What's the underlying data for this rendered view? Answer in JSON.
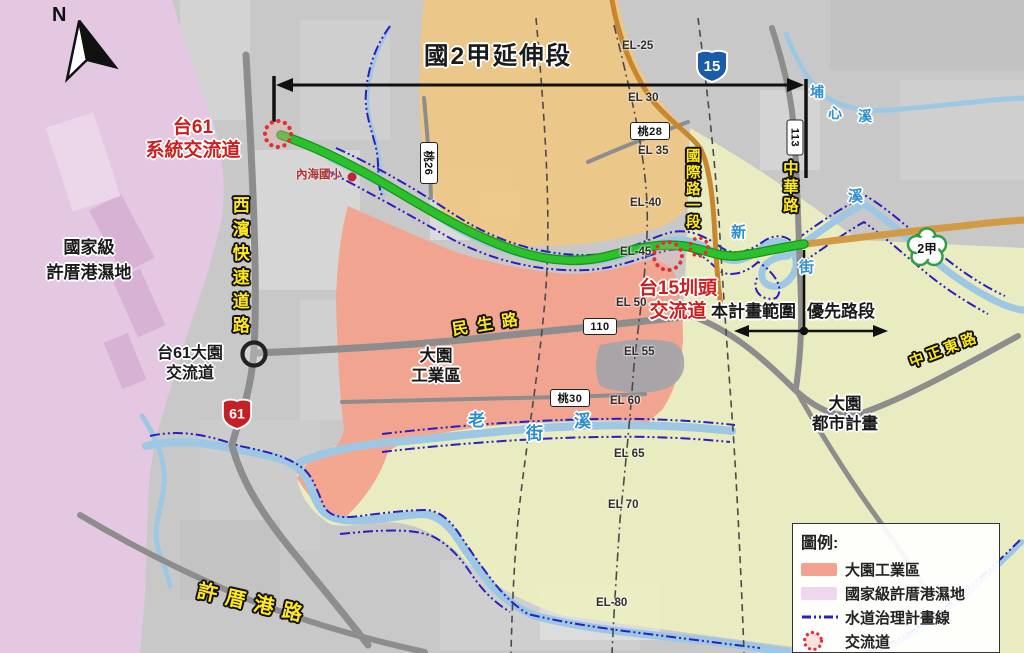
{
  "colors": {
    "route-green": "#2cc02c",
    "route-green-dark": "#179417",
    "road-brown": "#c8872e",
    "road-tan": "#d29a45",
    "river": "#9ec7e4",
    "waterline": "#2a1fbf",
    "wetland": "#e4c8e2",
    "industrial": "#f2a28e",
    "urban": "#ebedc0",
    "farm-orange": "#eec787",
    "label-red": "#cc2020",
    "label-blue": "#2e8fd0",
    "road-label-yellow": "#ffe81e",
    "shield-blue": "#1a5ca8",
    "shield-red": "#c42127",
    "shield-green": "#2f9e44"
  },
  "compass": {
    "label": "N"
  },
  "title": {
    "text": "國2甲延伸段"
  },
  "scope": {
    "project_range": "本計畫範圍",
    "priority_section": "優先路段"
  },
  "interchanges": {
    "tai61_system": "台61\n系統交流道",
    "tai61_dayuan": "台61大園\n交流道",
    "tai15_zhuntou": "台15圳頭\n交流道"
  },
  "areas": {
    "wetland": "國家級\n許厝港濕地",
    "industrial": "大園\n工業區",
    "urban_plan": "大園\n都市計畫"
  },
  "poi": {
    "neihai_school": "內海國小"
  },
  "roads": {
    "xibin": "西濱快速道路",
    "minsheng": "民生路",
    "guoji": "國際路一段",
    "zhonghua": "中華路",
    "zhongzheng_e": "中正東路",
    "xucuogang": "許厝港路"
  },
  "rivers": {
    "laojie": [
      "老",
      "街",
      "溪"
    ],
    "puxin": [
      "埔",
      "心",
      "溪"
    ],
    "xinjie": [
      "新",
      "街",
      "溪"
    ]
  },
  "markers": {
    "tao26": "桃26",
    "tao28": "桃28",
    "tao30": "桃30",
    "r110": "110",
    "r113": "113",
    "r15": "15",
    "r61": "61",
    "r2a": "2甲"
  },
  "el_labels": [
    "EL-25",
    "EL 30",
    "EL 35",
    "EL-40",
    "EL-45",
    "EL 50",
    "EL 55",
    "EL 60",
    "EL 65",
    "EL 70",
    "EL-80"
  ],
  "legend": {
    "title": "圖例:",
    "items": [
      {
        "label": "大園工業區"
      },
      {
        "label": "國家級許厝港濕地"
      },
      {
        "label": "水道治理計畫線"
      },
      {
        "label": "交流道"
      }
    ]
  }
}
